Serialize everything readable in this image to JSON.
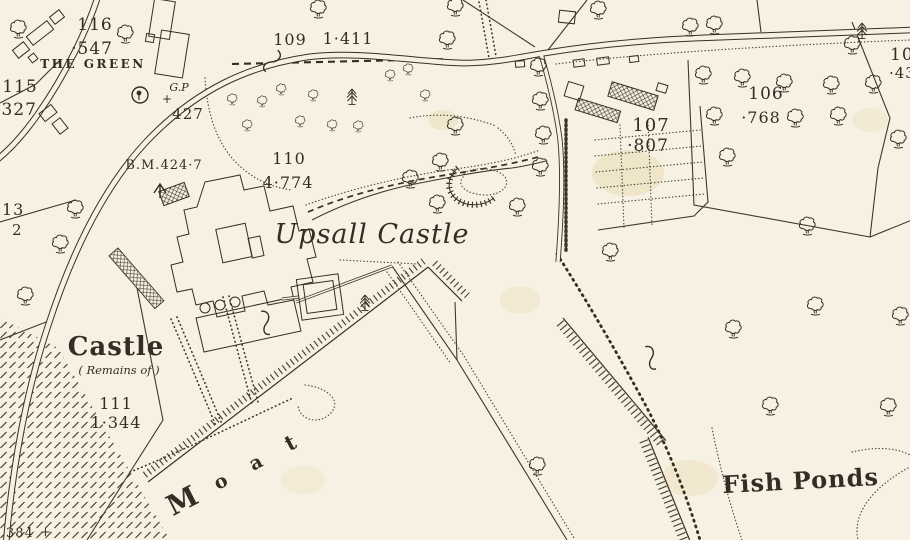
{
  "places": {
    "upsall_castle": "Upsall Castle",
    "the_green": "THE GREEN",
    "castle": "Castle",
    "castle_subtitle": "( Remains of )",
    "moat": [
      "M",
      "o",
      "a",
      "t"
    ],
    "fish_ponds": "Fish Ponds"
  },
  "parcels": {
    "p116": {
      "number": "116",
      "area": "·547"
    },
    "p115": {
      "number": "115",
      "area": "·327"
    },
    "p109": {
      "number": "109",
      "area": "1·411"
    },
    "p110": {
      "number": "110",
      "area": "4·774"
    },
    "p111": {
      "number": "111",
      "area": "1·344"
    },
    "p107": {
      "number": "107",
      "area": "·807"
    },
    "p106": {
      "number": "106",
      "area": "·768"
    },
    "p105_partial": {
      "number": "10",
      "area": "·434"
    },
    "p113_partial": {
      "number": "13",
      "area": "2"
    }
  },
  "annotations": {
    "benchmark": "B.M.424·7",
    "guide_post": "G.P",
    "guide_post_cross": "+",
    "spot_427": "427",
    "spot_384": "384",
    "spot_384_cross": "+"
  },
  "colors": {
    "paper": "#f6f1e2",
    "ink": "#332e24",
    "stain": "#e7d6ab"
  },
  "icons": {
    "deciduous_tree": "deciduous-tree-icon",
    "conifer_tree": "conifer-tree-icon",
    "shrub": "shrub-icon",
    "broad_arrow": "broad-arrow-icon",
    "guide_post_circle": "guide-post-icon",
    "parcel_brace": "brace-icon"
  },
  "trees": {
    "deciduous": [
      [
        318,
        10
      ],
      [
        455,
        8
      ],
      [
        447,
        41
      ],
      [
        538,
        68
      ],
      [
        540,
        102
      ],
      [
        598,
        11
      ],
      [
        690,
        28
      ],
      [
        714,
        26
      ],
      [
        852,
        46
      ],
      [
        703,
        76
      ],
      [
        742,
        79
      ],
      [
        784,
        84
      ],
      [
        831,
        86
      ],
      [
        873,
        85
      ],
      [
        714,
        117
      ],
      [
        795,
        119
      ],
      [
        838,
        117
      ],
      [
        727,
        158
      ],
      [
        898,
        140
      ],
      [
        610,
        253
      ],
      [
        807,
        227
      ],
      [
        815,
        307
      ],
      [
        900,
        317
      ],
      [
        733,
        330
      ],
      [
        770,
        407
      ],
      [
        888,
        408
      ],
      [
        537,
        467
      ],
      [
        455,
        127
      ],
      [
        440,
        163
      ],
      [
        410,
        180
      ],
      [
        437,
        205
      ],
      [
        517,
        208
      ],
      [
        540,
        168
      ],
      [
        543,
        136
      ],
      [
        75,
        210
      ],
      [
        60,
        245
      ],
      [
        25,
        297
      ],
      [
        125,
        35
      ],
      [
        18,
        30
      ]
    ],
    "shrubs": [
      [
        232,
        100
      ],
      [
        247,
        126
      ],
      [
        262,
        102
      ],
      [
        281,
        90
      ],
      [
        300,
        122
      ],
      [
        313,
        96
      ],
      [
        332,
        126
      ],
      [
        358,
        127
      ],
      [
        390,
        76
      ],
      [
        408,
        70
      ],
      [
        425,
        96
      ]
    ],
    "conifers": [
      [
        352,
        97
      ],
      [
        365,
        303
      ],
      [
        862,
        31
      ]
    ]
  }
}
